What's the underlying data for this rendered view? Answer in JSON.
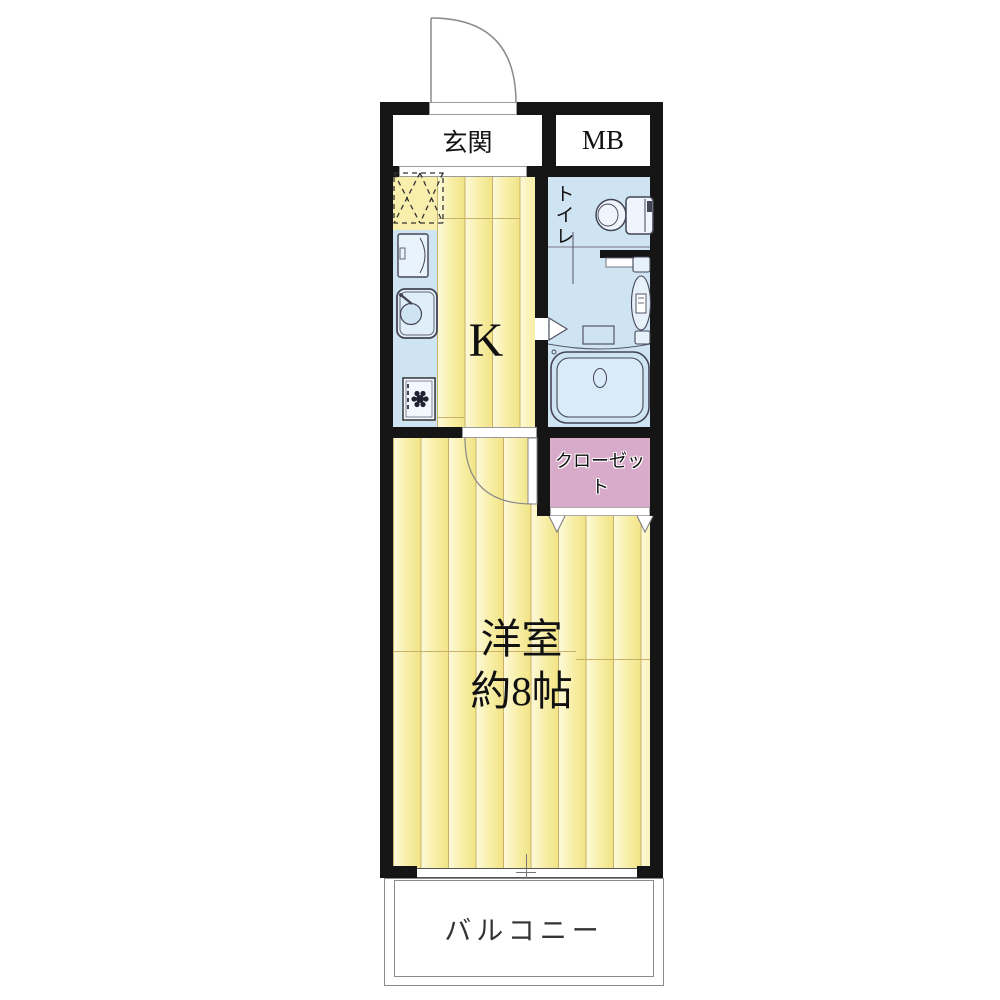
{
  "plan": {
    "type": "apartment-floor-plan",
    "rooms": {
      "genkan": {
        "label": "玄関"
      },
      "meter_box": {
        "label": "MB"
      },
      "kitchen": {
        "label": "K"
      },
      "toilet": {
        "label": "トイレ"
      },
      "closet": {
        "label": "クローゼット"
      },
      "main_room": {
        "label": "洋室",
        "size_label": "約8帖"
      },
      "balcony": {
        "label": "バルコニー"
      }
    },
    "colors": {
      "wall_black": "#151515",
      "floor_yellow": "#f8efa9",
      "water_blue": "#cfe4f2",
      "closet_pink": "#d9abca",
      "balcony_line": "#8a8a8a"
    }
  }
}
